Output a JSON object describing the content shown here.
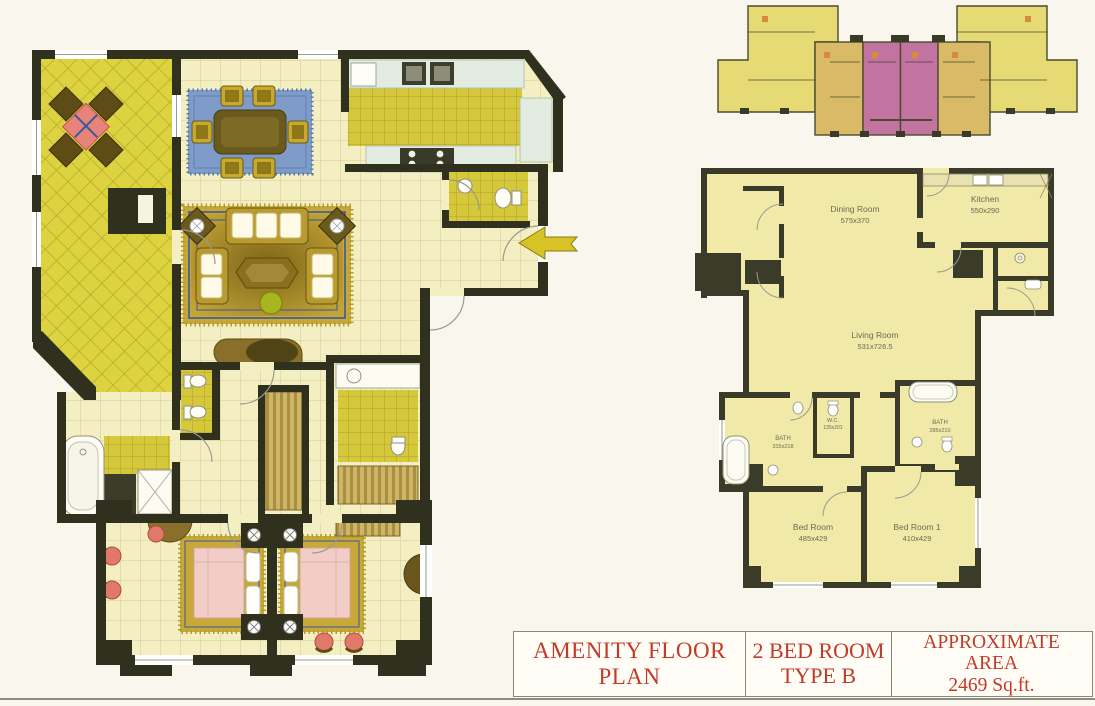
{
  "palette": {
    "wall": "#30301e",
    "floor_pale": "#f4efc2",
    "floor_tile": "#d5c83b",
    "terrace_tile": "#ddd23f",
    "counter_mint": "#e2ece0",
    "rug_gold": "#c8a938",
    "rug_blue": "#7e9cc7",
    "bed_pink": "#f2ccc6",
    "accent_coral": "#e0796a",
    "keyplan_highlight": "#c2739f",
    "keyplan_yellow": "#e6da74",
    "keyplan_tan": "#d9ba66",
    "schematic_floor": "#f0e9a8",
    "title_text": "#c23a28"
  },
  "schematic": {
    "rooms": {
      "dining": {
        "name": "Dining Room",
        "dims": "575x370"
      },
      "kitchen": {
        "name": "Kitchen",
        "dims": "550x290"
      },
      "living": {
        "name": "Living Room",
        "dims": "531x726.5"
      },
      "wc": {
        "name": "W.C.",
        "dims": "135x201"
      },
      "bath_a": {
        "name": "BATH",
        "dims": "315x218"
      },
      "bath_b": {
        "name": "BATH",
        "dims": "285x210"
      },
      "bedroom": {
        "name": "Bed Room",
        "dims": "485x429"
      },
      "bedroom1": {
        "name": "Bed Room 1",
        "dims": "410x429"
      }
    }
  },
  "title_block": {
    "amenity": "AMENITY FLOOR PLAN",
    "type_line1": "2 BED ROOM",
    "type_line2": "TYPE B",
    "area_line1": "APPROXIMATE",
    "area_line2": "AREA",
    "area_line3": "2469 Sq.ft."
  }
}
